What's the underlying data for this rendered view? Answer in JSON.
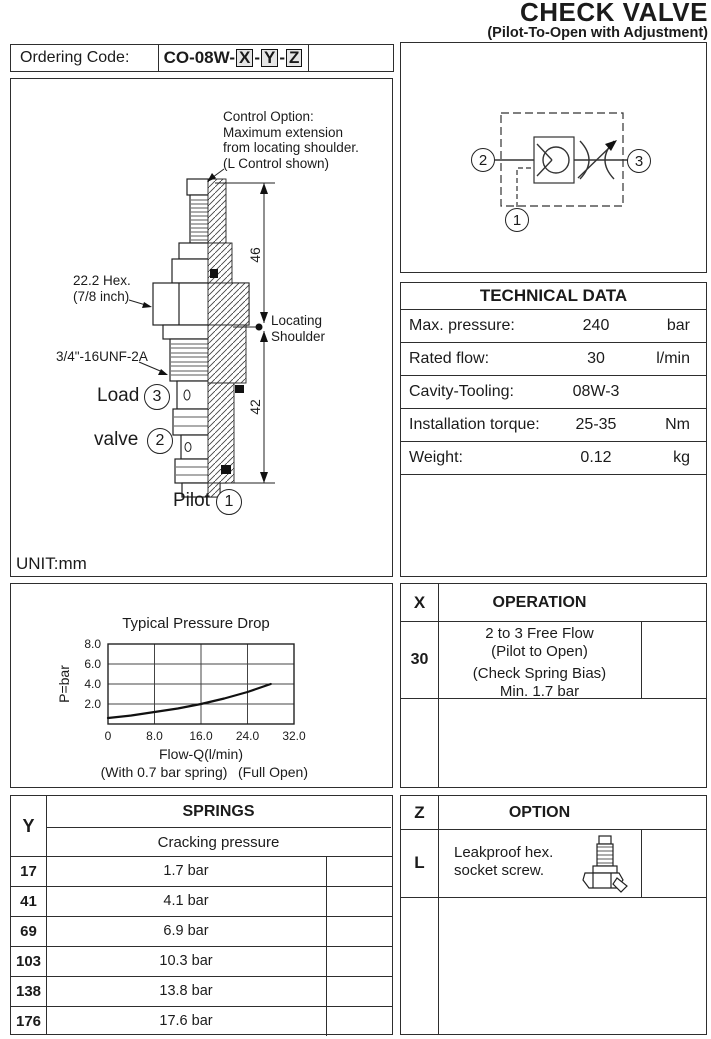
{
  "header": {
    "title": "CHECK VALVE",
    "subtitle": "(Pilot-To-Open with Adjustment)"
  },
  "ordering": {
    "label": "Ordering Code:",
    "code_prefix": "CO-08W-",
    "separator": "-",
    "code_parts": [
      "X",
      "Y",
      "Z"
    ]
  },
  "drawing": {
    "control_option_lines": [
      "Control Option:",
      "Maximum extension",
      "from locating shoulder.",
      "(L Control shown)"
    ],
    "hex_label_lines": [
      "22.2 Hex.",
      "(7/8 inch)"
    ],
    "thread_label": "3/4\"-16UNF-2A",
    "locating_shoulder_lines": [
      "Locating",
      "Shoulder"
    ],
    "dim_top": "46",
    "dim_bottom": "42",
    "port_load": {
      "label": "Load",
      "num": "3"
    },
    "port_valve": {
      "label": "valve",
      "num": "2"
    },
    "port_pilot": {
      "label": "Pilot",
      "num": "1"
    },
    "unit_note": "UNIT:mm"
  },
  "schematic": {
    "port_left": "2",
    "port_right": "3",
    "port_bottom": "1"
  },
  "technical_data": {
    "title": "TECHNICAL DATA",
    "rows": [
      {
        "label": "Max. pressure:",
        "value": "240",
        "unit": "bar"
      },
      {
        "label": "Rated flow:",
        "value": "30",
        "unit": "l/min"
      },
      {
        "label": "Cavity-Tooling:",
        "value": "08W-3",
        "unit": ""
      },
      {
        "label": "Installation torque:",
        "value": "25-35",
        "unit": "Nm"
      },
      {
        "label": "Weight:",
        "value": "0.12",
        "unit": "kg"
      }
    ]
  },
  "chart_data": {
    "type": "line",
    "title": "Typical Pressure Drop",
    "xlabel": "Flow-Q(l/min)",
    "ylabel": "P=bar",
    "footnotes": [
      "(With 0.7 bar spring)",
      "(Full Open)"
    ],
    "xlim": [
      0,
      32
    ],
    "ylim": [
      0,
      8
    ],
    "xticks": [
      0,
      8,
      16,
      24,
      32
    ],
    "xtick_labels": [
      "0",
      "8.0",
      "16.0",
      "24.0",
      "32.0"
    ],
    "yticks": [
      2,
      4,
      6,
      8
    ],
    "ytick_labels": [
      "2.0",
      "4.0",
      "6.0",
      "8.0"
    ],
    "grid": true,
    "legend": "none",
    "series": [
      {
        "name": "typical pressure drop",
        "x": [
          0,
          4,
          8,
          12,
          16,
          20,
          24,
          28
        ],
        "y": [
          0.6,
          0.85,
          1.2,
          1.55,
          2.0,
          2.55,
          3.2,
          4.0
        ]
      }
    ]
  },
  "operation": {
    "col_key": "X",
    "title": "OPERATION",
    "rows": [
      {
        "key": "30",
        "lines": [
          "2 to 3 Free Flow",
          "(Pilot to Open)",
          "(Check Spring Bias)",
          "Min. 1.7 bar"
        ]
      }
    ]
  },
  "springs": {
    "col_key": "Y",
    "title": "SPRINGS",
    "subtitle": "Cracking pressure",
    "rows": [
      {
        "key": "17",
        "value": "1.7 bar"
      },
      {
        "key": "41",
        "value": "4.1 bar"
      },
      {
        "key": "69",
        "value": "6.9 bar"
      },
      {
        "key": "103",
        "value": "10.3 bar"
      },
      {
        "key": "138",
        "value": "13.8 bar"
      },
      {
        "key": "176",
        "value": "17.6 bar"
      }
    ]
  },
  "option": {
    "col_key": "Z",
    "title": "OPTION",
    "rows": [
      {
        "key": "L",
        "lines": [
          "Leakproof hex.",
          "socket screw."
        ]
      }
    ]
  }
}
